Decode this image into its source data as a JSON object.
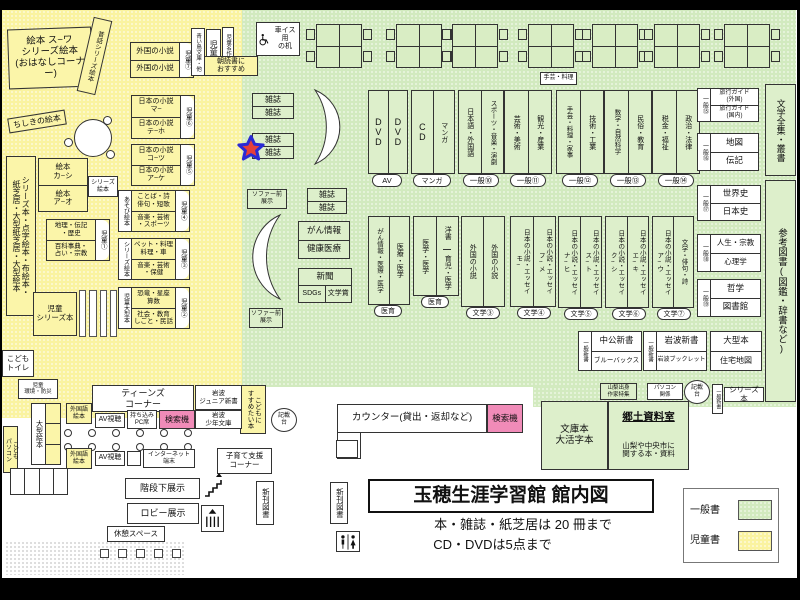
{
  "title": {
    "main": "玉穂生涯学習館 館内図",
    "rule1": "本・雑誌・紙芝居は 20 冊まで",
    "rule2": "CD・DVDは5点まで"
  },
  "legend": {
    "general": "一般書",
    "children": "児童書"
  },
  "colors": {
    "children_bg": "#FAF3A0",
    "general_bg": "#D2EABF",
    "search_pink": "#F08BB8",
    "star_red": "#E5403A",
    "star_blue": "#2A2AD4"
  },
  "kids": {
    "ehon_corner": "絵本 ス~ワ\nシリーズ絵本\n(おはなしコーナー)",
    "mukashi": "昔話シリーズ絵本",
    "chishiki": "ちしきの絵本",
    "jidousho": "児童書",
    "aoitori": "青い鳥文庫・他",
    "meisaku": "児童名作",
    "asadoku": "朝読書に\nおすすめ",
    "s7": {
      "r1": "外国の小説",
      "r2": "外国の小説",
      "badge": "児童⑦"
    },
    "s6": {
      "r1": "日本の小説\nマ~",
      "r2": "日本の小説\nテ~ホ",
      "badge": "児童⑥"
    },
    "s5": {
      "r1": "日本の小説\nコ~ツ",
      "r2": "日本の小説\nア~ケ",
      "badge": "児童⑤"
    },
    "s4": {
      "side": "あそび絵本",
      "r1": "ことば・詩\n俳句・短歌",
      "r2": "音楽・芸術\n・スポーツ",
      "badge": "児童④"
    },
    "s3": {
      "side": "シリーズ絵本",
      "r1": "ペット・料理\n料理・車",
      "r2": "音楽・芸術\n・保健",
      "badge": "児童③"
    },
    "s2": {
      "side": "児童大型本",
      "r1": "恐竜・星座\n算数",
      "r2": "社会・教育\nしごと・民話",
      "badge": "児童②"
    },
    "s1": {
      "r1": "地理・伝記\n・歴史",
      "r2": "百科事典・\n占い・宗教",
      "badge": "児童①"
    },
    "ehon": {
      "r1": "絵本\nカ~シ",
      "r2": "絵本\nア~オ",
      "side": "シリーズ\n絵本"
    },
    "tall": "シリーズ本・点字絵本・布絵本・\n紙芝居・大型紙芝居・大型絵本",
    "series": "児童\nシリーズ本",
    "toilet": "こども\nトイレ",
    "kankyo": "児童\n環境・防災",
    "oogata": "大型絵本",
    "pc": "こども\nパソコン",
    "susume": "こどもに\nすすめたい本"
  },
  "gen": {
    "wheel": "車イス用\nの机",
    "shugei": "手芸・料理",
    "mag": "雑誌",
    "sofa": "ソファー前\n展示",
    "av": {
      "c1": "DVD",
      "c2": "DVD",
      "badge": "AV"
    },
    "cd": {
      "c1": "CD",
      "c2": "マンガ",
      "badge": "マンガ"
    },
    "g10": {
      "c1": "日本語・外国語",
      "c2": "スポーツ・音楽・演劇",
      "badge": "一般⑩"
    },
    "g11": {
      "c1": "芸術・美術",
      "c2": "観光・産業",
      "badge": "一般⑪"
    },
    "g12": {
      "c1": "手芸・料理・家事",
      "c2": "技術・工業",
      "badge": "一般⑫"
    },
    "g13": {
      "c1": "数学・自然科学",
      "c2": "民俗・教育",
      "badge": "一般⑬"
    },
    "g14": {
      "c1": "税金・福祉",
      "c2": "政治・法律",
      "badge": "一般⑭"
    },
    "g15": {
      "badge": "一般⑮",
      "r1": "旅行ガイド\n(外国)",
      "r2": "旅行ガイド\n(国内)"
    },
    "g16": {
      "badge": "一般⑯",
      "r1": "地図",
      "r2": "伝記"
    },
    "g17": {
      "badge": "一般⑰",
      "r1": "世界史",
      "r2": "日本史"
    },
    "g18": {
      "badge": "一般⑱",
      "r1": "人生・宗教",
      "r2": "心理学"
    },
    "g19": {
      "badge": "一般⑲",
      "r1": "哲学",
      "r2": "図書館"
    },
    "zenshu": "文学全集・叢書",
    "sanko": "参考図書(図鑑・辞書など)",
    "gan": {
      "r1": "がん情報",
      "r2": "健康医療"
    },
    "news": {
      "r1": "新聞",
      "c1": "SDGs",
      "c2": "文学賞"
    },
    "med1": {
      "c1": "がん情報・医療・医学",
      "c2": "医療・医学",
      "badge": "医育"
    },
    "med2": {
      "c1": "医学・医学",
      "c2a": "洋書",
      "c2b": "育児・医学",
      "badge": "医育"
    },
    "lit3": {
      "c1": "外国の小説",
      "c2": "外国の小説",
      "badge": "文学③"
    },
    "lit4": {
      "c1": "日本の小説・エッセイ\nモ~",
      "c2": "日本の小説・エッセイ\nフ~メ",
      "badge": "文学④"
    },
    "lit5": {
      "c1": "日本の小説・エッセイ\nナ~ヒ",
      "c2": "日本の小説・エッセイ\nス~ト",
      "badge": "文学⑤"
    },
    "lit6": {
      "c1": "日本の小説・エッセイ\nク~シ",
      "c2": "日本の小説・エッセイ\nエ~キ",
      "badge": "文学⑥"
    },
    "lit7": {
      "c1": "日本の小説・エッセイ\nア~ウ",
      "c2": "文学・俳句・詩",
      "badge": "文学⑦"
    },
    "chuko": {
      "badge": "一般新書",
      "r1": "中公新書",
      "r2": "ブルーバックス"
    },
    "iwa": {
      "badge": "一般新書",
      "r1": "岩波新書",
      "r2": "岩波ブックレット"
    },
    "oogata": {
      "r1": "大型本",
      "r2": "住宅地図"
    },
    "yamanashi": "山梨出身\n作家特集",
    "pc": "パソコン\n関係",
    "kisai": "記載\n台",
    "shinsho": "一般新書",
    "series": "シリーズ本",
    "bunko": "文庫本\n大活字本",
    "kyodo": {
      "t": "郷土資料室",
      "d": "山梨や中央市に\n関する本・資料"
    },
    "counter": "カウンター(貸出・返却など)",
    "search": "検索機"
  },
  "teens": {
    "corner": "ティーンズ\nコーナー",
    "gaikoku": "外国語\n絵本",
    "av": "AV視聴",
    "pc": "持ち込み\nPC席",
    "search": "検索機",
    "jr": "岩波\nジュニア新書",
    "shonen": "岩波\n少年文庫",
    "net": "インターネット\n端末",
    "kosodate": "子育て支援\nコーナー",
    "kaidan": "階段下展示",
    "lobby": "ロビー展示",
    "kyukei": "休憩スペース",
    "shinkan": "新刊図書"
  }
}
